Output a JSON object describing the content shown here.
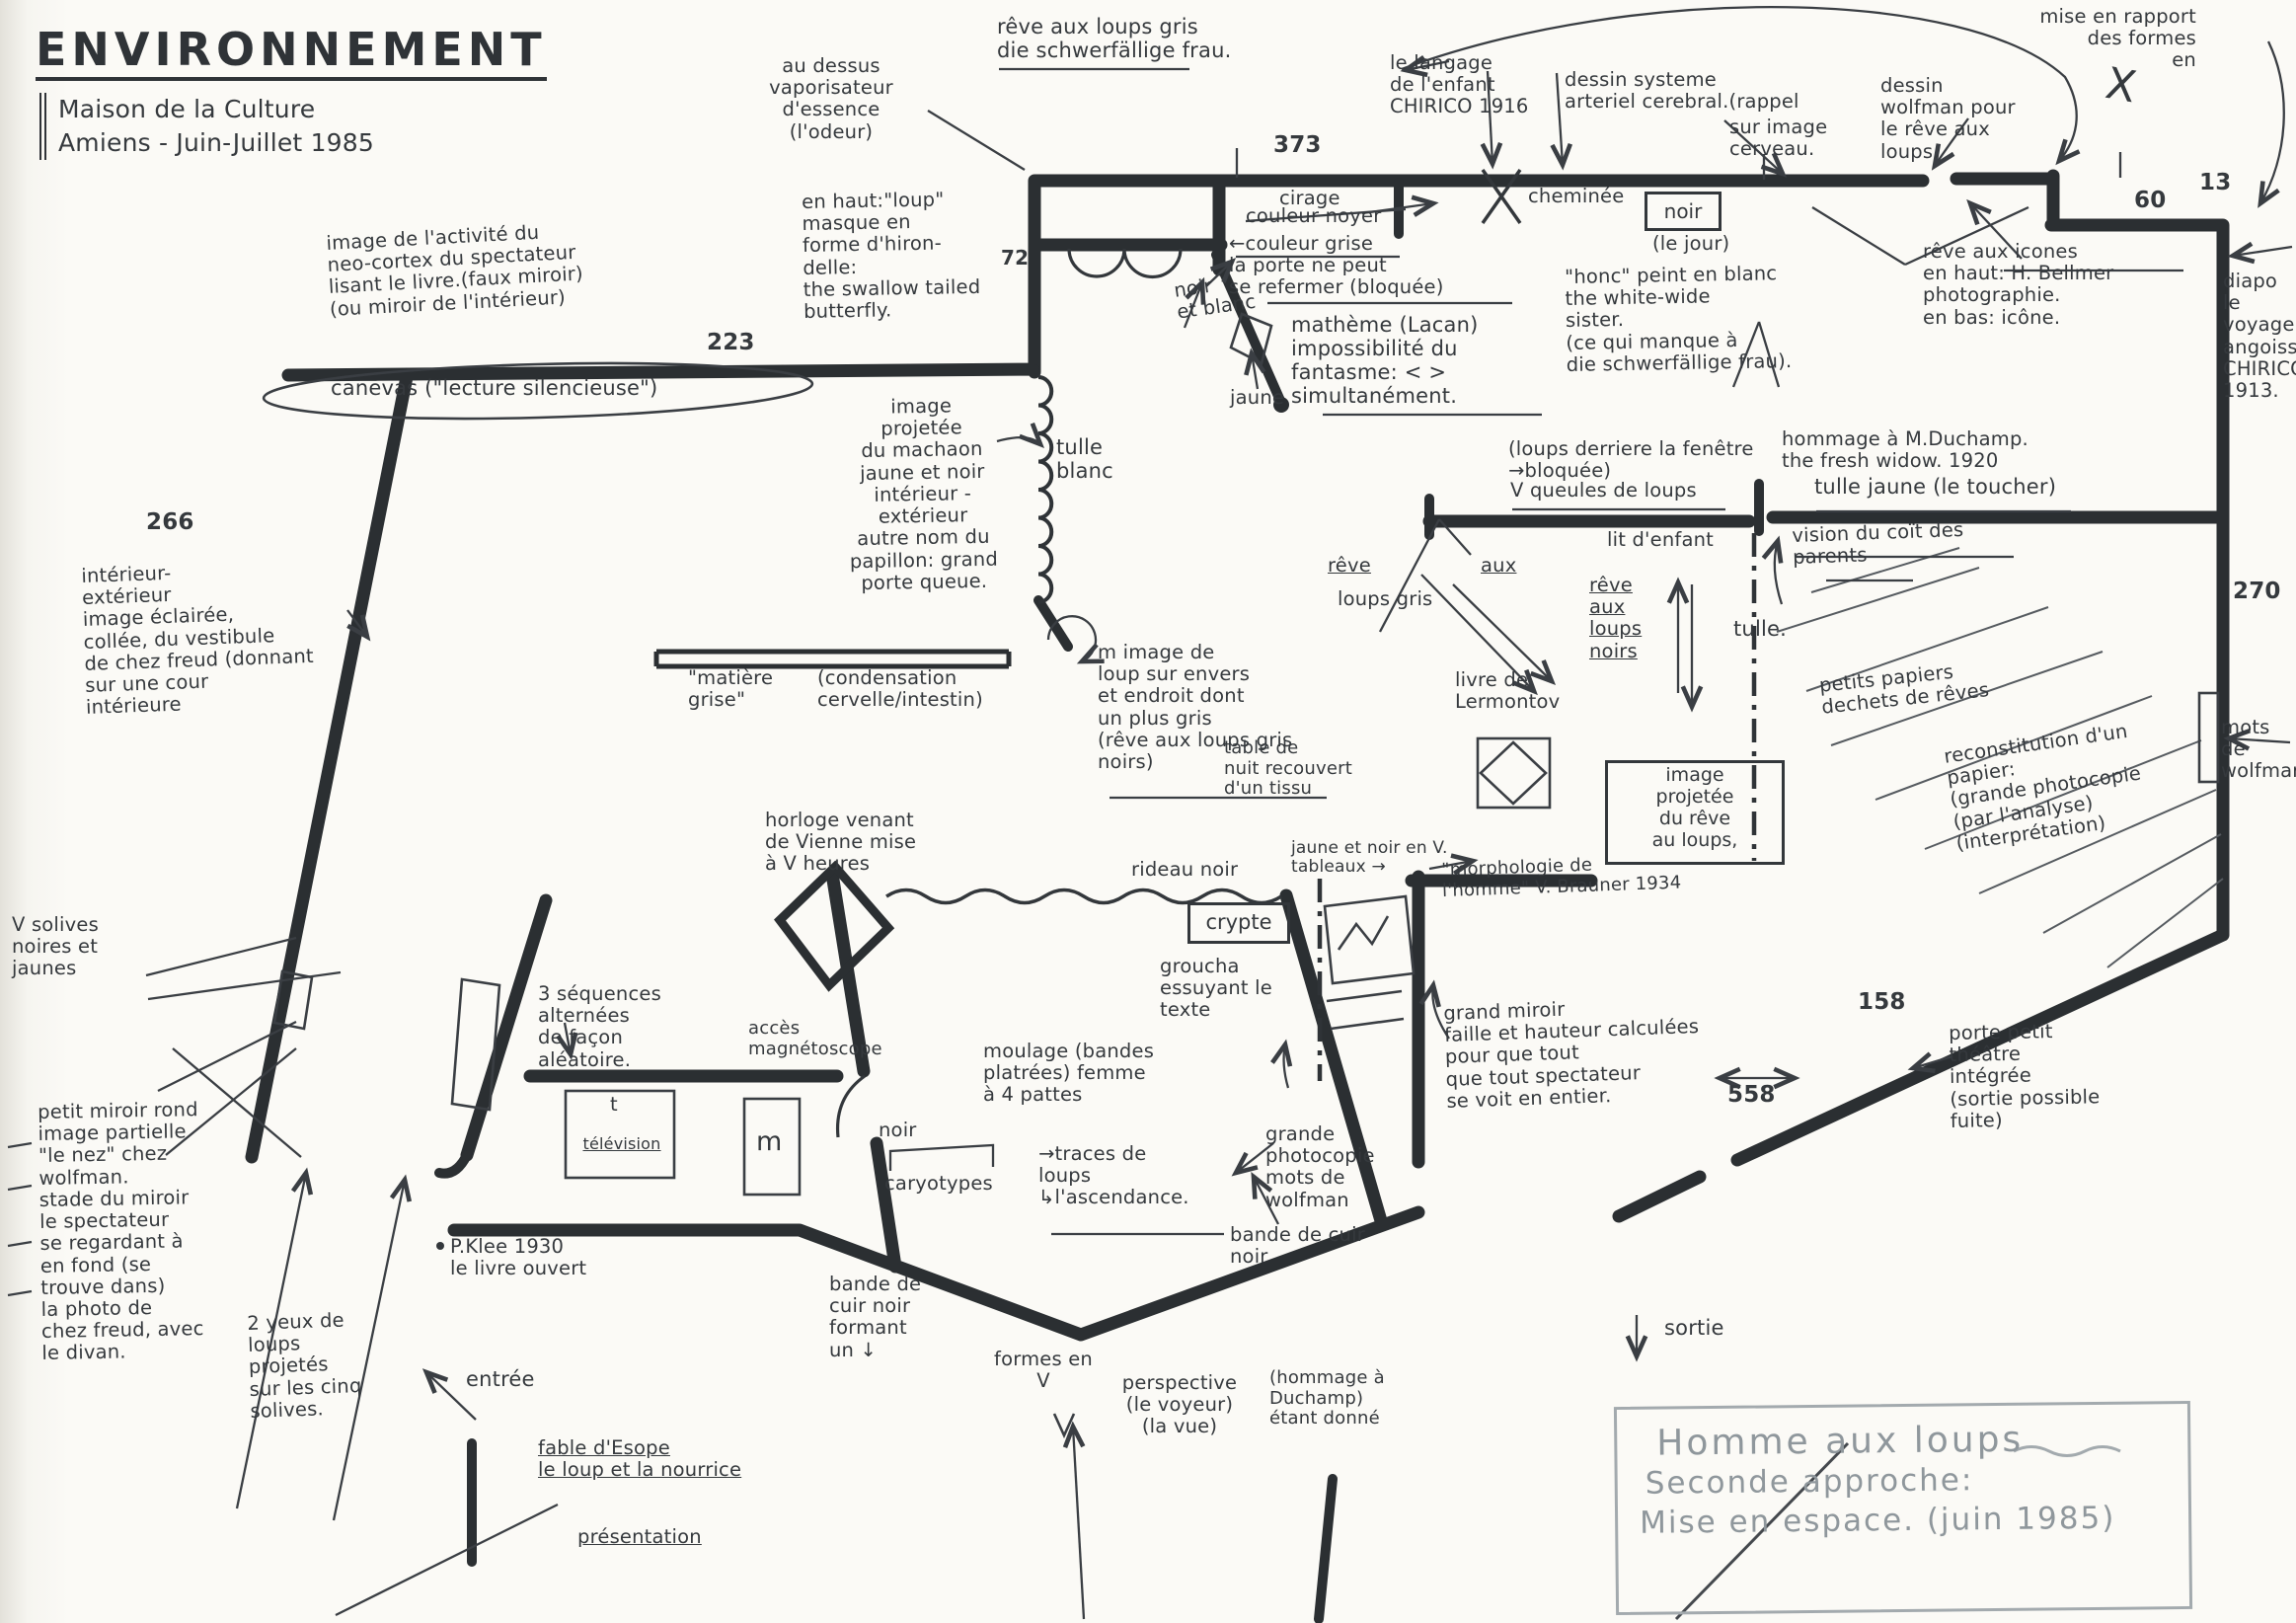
{
  "document": {
    "type": "hand-drawn exhibition floor plan",
    "language": "French"
  },
  "colors": {
    "ink": "#2b2f32",
    "text_ink": "#35393d",
    "thin_line": "#44484d",
    "pencil": "#8f979c",
    "paper": "#fbfaf6"
  },
  "a": {
    "title": "ENVIRONNEMENT",
    "subtitle": [
      "Maison de la Culture",
      "Amiens - Juin-Juillet 1985"
    ],
    "odeur": [
      "au dessus",
      "vaporisateur",
      "d'essence",
      "(l'odeur)"
    ],
    "revegris": [
      "rêve aux loups gris",
      "die schwerfällige frau."
    ],
    "langage": [
      "le langage",
      "de l'enfant",
      "CHIRICO 1916"
    ],
    "systeme": [
      "dessin systeme",
      "arteriel cerebral.(rappel"
    ],
    "cerveau": [
      "sur image",
      "cerveau."
    ],
    "wolfdessin": [
      "dessin",
      "wolfman pour",
      "le rêve aux",
      "loups."
    ],
    "rapport": [
      "mise en rapport",
      "des formes",
      "en"
    ],
    "bigx": "X",
    "n373": "373",
    "n223": "223",
    "n266": "266",
    "n60": "60",
    "n13": "13",
    "n270": "270",
    "n158": "158",
    "n558": "558",
    "n72": "72",
    "masque": [
      "en haut:\"loup\"",
      "masque en",
      "forme d'hiron-",
      "delle:",
      "the swallow tailed",
      "butterfly."
    ],
    "neocortex": [
      "image de l'activité du",
      "neo-cortex du spectateur",
      "lisant le livre.(faux miroir)",
      "(ou miroir de l'intérieur)"
    ],
    "canevas": "canevas (\"lecture silencieuse\")",
    "cirage": "cirage",
    "noyer": "couleur noyer",
    "grise": [
      "←couleur grise",
      "la porte ne peut",
      "se refermer (bloquée)"
    ],
    "matheme": [
      "mathème (Lacan)",
      "impossibilité du",
      "fantasme: < >",
      "simultanément."
    ],
    "noirblanc": [
      "noir",
      "et blanc"
    ],
    "jaune": "jaune",
    "cheminee": "cheminée",
    "noirbox": "noir",
    "lejour": "(le jour)",
    "honc": [
      "\"honc\" peint en blanc",
      "the white-wide",
      "sister.",
      "(ce qui manque à",
      "die schwerfällige frau)."
    ],
    "icones": [
      "rêve aux icones",
      "en haut: H. Bellmer",
      "photographie.",
      "en bas: icône."
    ],
    "diapo": [
      "diapo",
      "le",
      "voyage",
      "angoissé",
      "CHIRICO",
      "1913."
    ],
    "fenetre": [
      "(loups derriere la fenêtre",
      "→bloquée)"
    ],
    "queules": "V queules de loups",
    "duchamp": [
      "hommage à M.Duchamp.",
      "the fresh widow. 1920"
    ],
    "tullejaune": "tulle jaune (le toucher)",
    "vision": [
      "vision du coït des",
      "parents"
    ],
    "litenfant": "lit d'enfant",
    "revenoirs": [
      "rêve",
      "aux",
      "loups",
      "noirs"
    ],
    "reve2": "rêve",
    "aux2": "aux",
    "loupsgris2": "loups gris",
    "tulledot": "tulle.",
    "lermontov": [
      "livre de",
      "Lermontov"
    ],
    "imageproj": [
      "image",
      "projetée",
      "du rêve",
      "au loups,"
    ],
    "tablenuit": [
      "table de",
      "nuit recouvert",
      "d'un tissu"
    ],
    "tablenuit2": [
      "jaune et noir en V.",
      "tableaux →"
    ],
    "mimage": [
      "m image de",
      "loup sur envers",
      "et endroit dont",
      "un plus gris",
      "(rêve aux loups gris",
      "noirs)"
    ],
    "papiers": [
      "petits papiers",
      "dechets de rêves"
    ],
    "reconstitution": [
      "reconstitution d'un",
      "papier:",
      "(grande photocopie",
      "(par l'analyse)",
      "(interprétation)"
    ],
    "motswolf": [
      "mots",
      "de",
      "wolfman"
    ],
    "interieur": [
      "intérieur-",
      "extérieur",
      "image éclairée,",
      "collée, du vestibule",
      "de chez freud (donnant",
      "sur une cour",
      "intérieure"
    ],
    "tulleblanc": [
      "tulle",
      "blanc"
    ],
    "machaon": [
      "image",
      "projetée",
      "du machaon",
      "jaune et noir",
      "intérieur -",
      "extérieur",
      "autre nom du",
      "papillon: grand",
      "porte queue."
    ],
    "matiere": [
      "\"matière",
      "grise\""
    ],
    "condensation": [
      "(condensation",
      "cervelle/intestin)"
    ],
    "horloge": [
      "horloge venant",
      "de Vienne mise",
      "à V heures"
    ],
    "rideau": "rideau noir",
    "cryptebox": "crypte",
    "sequences": [
      "3 séquences",
      "alternées",
      "de façon",
      "aléatoire."
    ],
    "acces": [
      "accès",
      "magnétoscope"
    ],
    "tv": "télévision",
    "tvt": "t",
    "mbox": "m",
    "pklee": [
      "P.Klee 1930",
      "le livre ouvert"
    ],
    "noir2": "noir",
    "caryotypes": "caryotypes",
    "traces": [
      "→traces de",
      "loups",
      "↳l'ascendance."
    ],
    "moulage": [
      "moulage (bandes",
      "platrées) femme",
      "à 4 pattes"
    ],
    "groucha": [
      "groucha",
      "essuyant le",
      "texte"
    ],
    "photocopie": [
      "grande",
      "photocopie",
      "mots de",
      "wolfman"
    ],
    "morphologie": [
      "\"morphologie de",
      "l'homme\" V. Brauner 1934"
    ],
    "miroir": [
      "grand miroir",
      "faille et hauteur calculées",
      "pour que tout",
      "que tout spectateur",
      "se voit en entier."
    ],
    "formes": [
      "formes en",
      "V"
    ],
    "bande1": [
      "bande de",
      "cuir noir",
      "formant",
      "un  ↓"
    ],
    "perspective": [
      "perspective",
      "(le voyeur)",
      "(la vue)"
    ],
    "hommage2": [
      "(hommage à",
      "Duchamp)",
      "étant donné"
    ],
    "bande2": [
      "bande de cuir",
      "noir"
    ],
    "sortie": "sortie",
    "porte": [
      "porte petit",
      "théâtre",
      "intégrée",
      "(sortie possible",
      "fuite)"
    ],
    "solives": [
      "V solives",
      "noires et",
      "jaunes"
    ],
    "miroirrond": [
      "petit miroir rond",
      "image partielle",
      "\"le nez\" chez",
      "wolfman.",
      "stade du miroir",
      "le spectateur",
      "se regardant à",
      "en fond (se",
      "trouve dans)",
      "la photo de",
      "chez freud, avec",
      "le divan."
    ],
    "yeux": [
      "2 yeux de",
      "loups",
      "projetés",
      "sur les cinq",
      "solives."
    ],
    "entree": "entrée",
    "fable": [
      "fable d'Esope",
      "le loup et la nourrice"
    ],
    "presentation": "présentation",
    "pencil1": "Homme aux loups",
    "pencil2": "Seconde approche:",
    "pencil3": "Mise en espace. (juin 1985)"
  }
}
